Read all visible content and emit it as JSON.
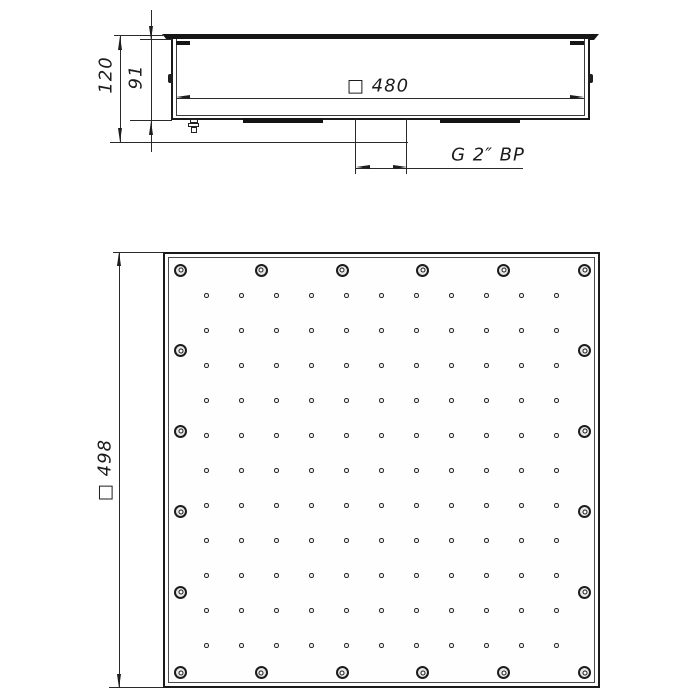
{
  "drawing": {
    "type": "technical-drawing",
    "side_view": {
      "dim_total_height": "120",
      "dim_body_height": "91",
      "dim_face_width": "□ 480",
      "thread_label": "G 2″ BP"
    },
    "front_view": {
      "dim_face_size": "□ 498",
      "screws_per_side": 6,
      "nozzle_rows": 11,
      "nozzle_cols": 11
    },
    "colors": {
      "line": "#1d1d1d",
      "background": "#ffffff"
    }
  }
}
